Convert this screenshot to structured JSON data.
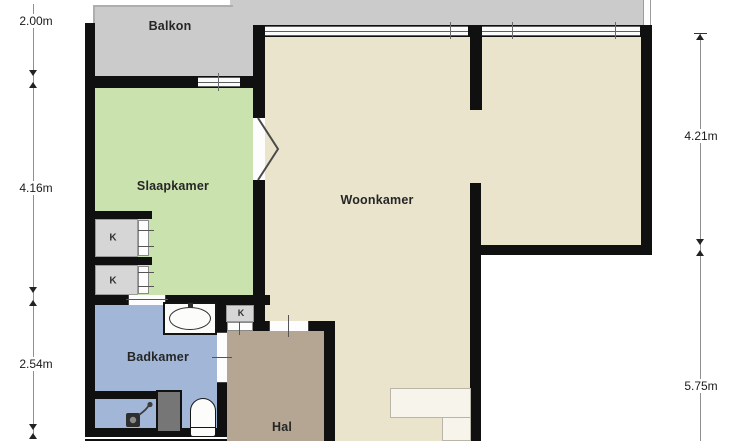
{
  "rooms": {
    "balkon": {
      "label": "Balkon",
      "color": "#cbcbcb"
    },
    "slaapkamer": {
      "label": "Slaapkamer",
      "color": "#c9e2ae"
    },
    "woonkamer": {
      "label": "Woonkamer",
      "color": "#eae4cc"
    },
    "badkamer": {
      "label": "Badkamer",
      "color": "#a2b7d7"
    },
    "hal": {
      "label": "Hal",
      "color": "#b5a593"
    }
  },
  "closets": {
    "label": "K"
  },
  "walls": {
    "color": "#101010"
  },
  "dimensions": {
    "left": [
      {
        "label": "2.00m"
      },
      {
        "label": "4.16m"
      },
      {
        "label": "2.54m"
      }
    ],
    "right": [
      {
        "label": "4.21m"
      },
      {
        "label": "5.75m"
      }
    ]
  }
}
